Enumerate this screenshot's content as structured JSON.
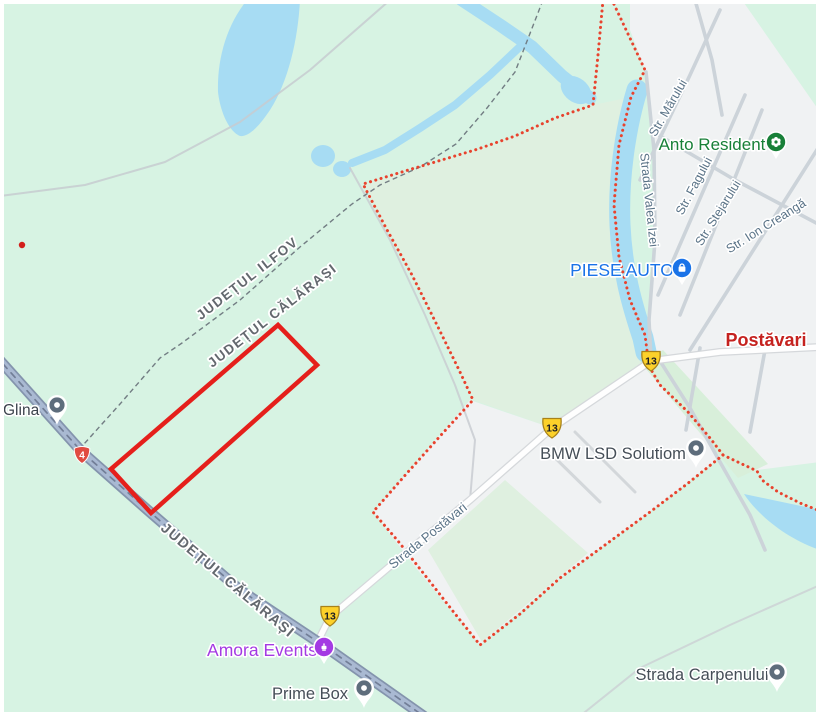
{
  "map": {
    "region_labels": {
      "county_ilfov": "JUDEȚUL ILFOV",
      "county_calarasi": "JUDEȚUL CĂLĂRAȘI",
      "county_calarasi_road": "JUDEȚUL CĂLĂRAȘI",
      "locality_postavari": "Postăvari",
      "locality_glina": "Glina"
    },
    "streets": {
      "marului": "Str. Mărului",
      "fagului": "Str. Fagului",
      "stejarului": "Str. Stejarului",
      "ion_creanga": "Str. Ion Creangă",
      "valea_izei": "Strada Valea Izei",
      "strada_postavari": "Strada Postăvari",
      "carpenului": "Strada Carpenului"
    },
    "places": {
      "anto_resident": "Anto Resident",
      "piese_auto": "PIESE AUTO",
      "amora_events": "Amora Events",
      "prime_box": "Prime Box",
      "bmw_lsd": "BMW LSD Solutiom"
    },
    "routes": {
      "dn": "4",
      "dj": "13"
    },
    "colors": {
      "land": "#d7f3e3",
      "land_muted": "#dff0e0",
      "urban": "#f0f2f3",
      "water": "#a7dcf3",
      "road_major_fill": "#a9b9d2",
      "road_major_casing": "#8494ad",
      "road_minor": "#fefefe",
      "boundary_red": "#e8432e",
      "plot_red": "#e51f1b",
      "route_dn_red": "#e14b41",
      "route_dj_yellow": "#fcd12a",
      "poi_blue": "#1a73e8",
      "poi_green": "#188038",
      "poi_purple": "#a43ae3",
      "poi_gray_text": "#454e57",
      "locality_red": "#c5221f",
      "county_text": "#63686e",
      "street_text": "#5a7387"
    }
  }
}
